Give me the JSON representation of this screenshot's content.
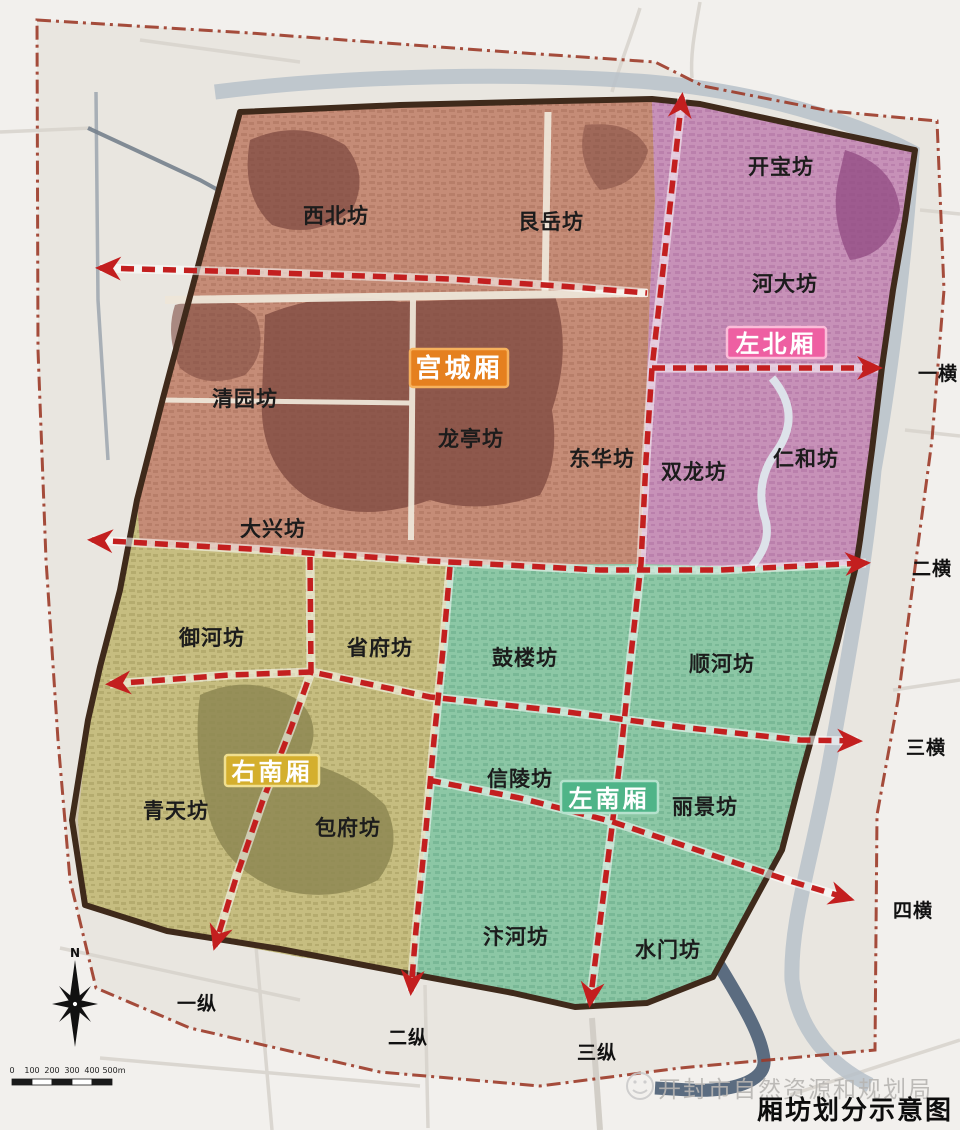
{
  "title": "厢坊划分示意图",
  "watermark": "开封市自然资源和规划局",
  "compass_n": "N",
  "scale": [
    "0",
    "100",
    "200",
    "300",
    "400",
    "500m"
  ],
  "zones": [
    {
      "name": "宫城厢",
      "color": "#e5801f",
      "border": "#f7b25c",
      "fabric": "#c58c77"
    },
    {
      "name": "左北厢",
      "color": "#ee5fa2",
      "border": "#fbbcd9",
      "fabric": "#c791b8"
    },
    {
      "name": "右南厢",
      "color": "#d4af2e",
      "border": "#f0df90",
      "fabric": "#c6bd80"
    },
    {
      "name": "左南厢",
      "color": "#4fb488",
      "border": "#b5e2cd",
      "fabric": "#8cc7a5"
    }
  ],
  "wards": [
    "西北坊",
    "艮岳坊",
    "开宝坊",
    "河大坊",
    "清园坊",
    "龙亭坊",
    "东华坊",
    "双龙坊",
    "仁和坊",
    "大兴坊",
    "御河坊",
    "省府坊",
    "鼓楼坊",
    "顺河坊",
    "青天坊",
    "包府坊",
    "信陵坊",
    "丽景坊",
    "汴河坊",
    "水门坊"
  ],
  "roads": [
    "一横",
    "二横",
    "三横",
    "四横",
    "一纵",
    "二纵",
    "三纵"
  ],
  "road_color": "#c31f1f",
  "wall_color": "#3f2a1b",
  "boundary_color": "#9c3a28"
}
